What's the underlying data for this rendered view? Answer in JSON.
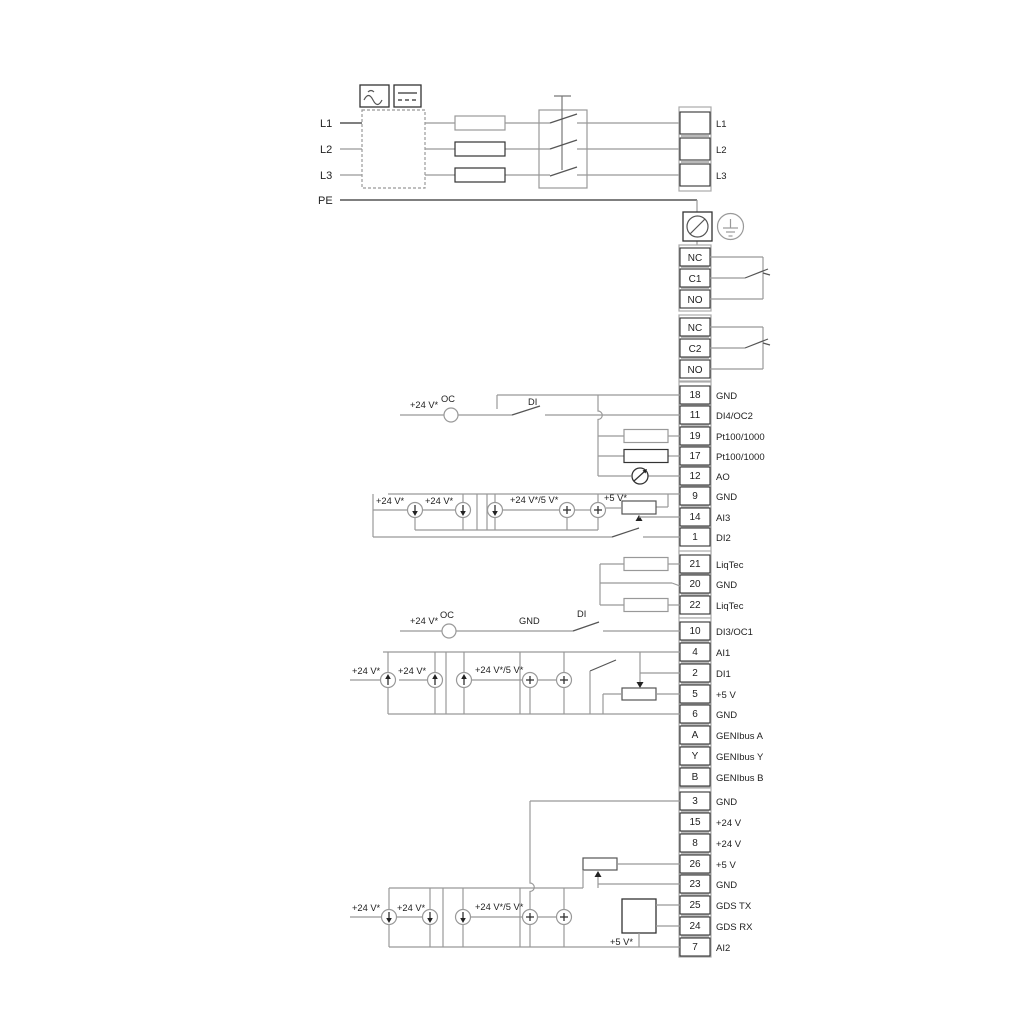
{
  "colors": {
    "background": "#ffffff",
    "wire_gray": "#999999",
    "wire_black": "#333333",
    "text": "#222222"
  },
  "left_labels": {
    "l1": "L1",
    "l2": "L2",
    "l3": "L3",
    "pe": "PE"
  },
  "ann": {
    "plus24": "+24 V*",
    "plus24_5": "+24 V*/5 V*",
    "plus5": "+5 V*",
    "oc": "OC",
    "di": "DI",
    "gnd": "GND"
  },
  "power_block": {
    "rows": [
      {
        "label": "L1"
      },
      {
        "label": "L2"
      },
      {
        "label": "L3"
      }
    ]
  },
  "relay1": {
    "rows": [
      {
        "label": "NC"
      },
      {
        "label": "C1"
      },
      {
        "label": "NO"
      }
    ]
  },
  "relay2": {
    "rows": [
      {
        "label": "NC"
      },
      {
        "label": "C2"
      },
      {
        "label": "NO"
      }
    ]
  },
  "main1": {
    "rows": [
      {
        "num": "18",
        "label": "GND"
      },
      {
        "num": "11",
        "label": "DI4/OC2"
      },
      {
        "num": "19",
        "label": "Pt100/1000"
      },
      {
        "num": "17",
        "label": "Pt100/1000"
      },
      {
        "num": "12",
        "label": "AO"
      },
      {
        "num": "9",
        "label": "GND"
      },
      {
        "num": "14",
        "label": "AI3"
      },
      {
        "num": "1",
        "label": "DI2"
      }
    ]
  },
  "liqtec": {
    "rows": [
      {
        "num": "21",
        "label": "LiqTec"
      },
      {
        "num": "20",
        "label": "GND"
      },
      {
        "num": "22",
        "label": "LiqTec"
      }
    ]
  },
  "main2": {
    "rows": [
      {
        "num": "10",
        "label": "DI3/OC1"
      },
      {
        "num": "4",
        "label": "AI1"
      },
      {
        "num": "2",
        "label": "DI1"
      },
      {
        "num": "5",
        "label": "+5 V"
      },
      {
        "num": "6",
        "label": "GND"
      },
      {
        "num": "A",
        "label": "GENIbus A"
      },
      {
        "num": "Y",
        "label": "GENIbus Y"
      },
      {
        "num": "B",
        "label": "GENIbus B"
      }
    ]
  },
  "main3": {
    "rows": [
      {
        "num": "3",
        "label": "GND"
      },
      {
        "num": "15",
        "label": "+24 V"
      },
      {
        "num": "8",
        "label": "+24 V"
      },
      {
        "num": "26",
        "label": "+5 V"
      },
      {
        "num": "23",
        "label": "GND"
      },
      {
        "num": "25",
        "label": "GDS TX"
      },
      {
        "num": "24",
        "label": "GDS RX"
      },
      {
        "num": "7",
        "label": "AI2"
      }
    ]
  }
}
